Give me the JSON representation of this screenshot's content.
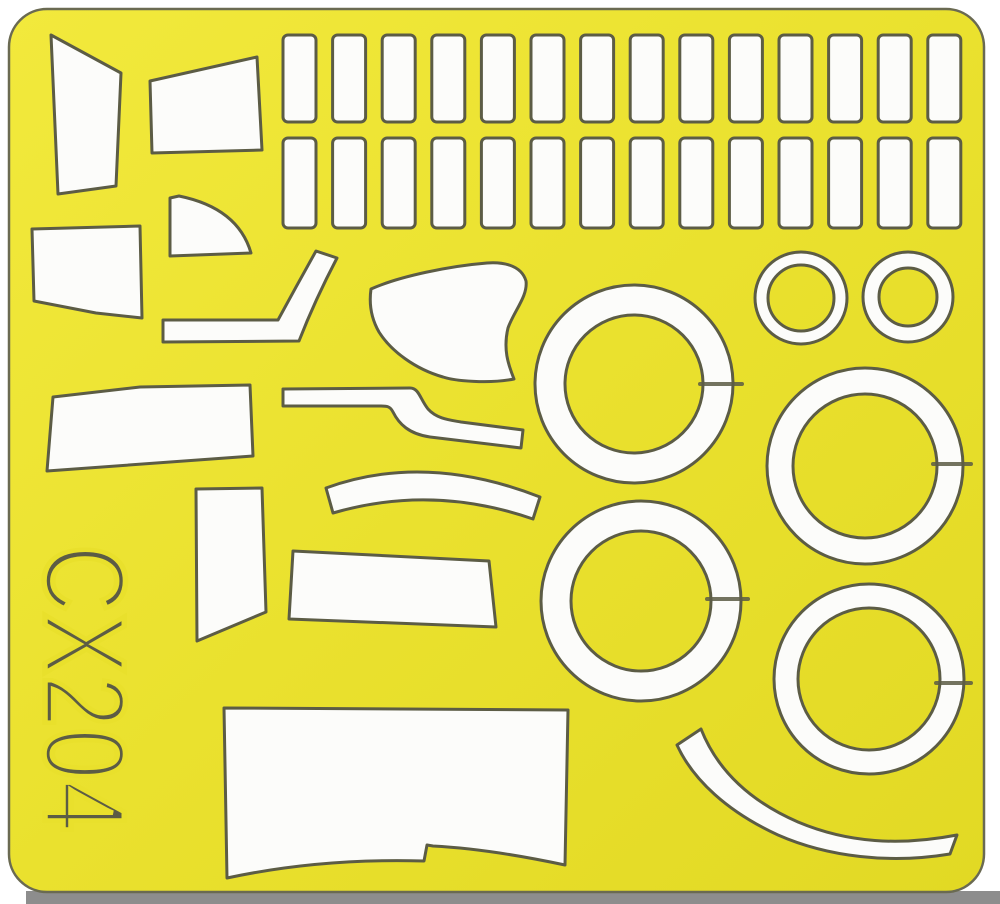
{
  "sheet": {
    "code": "CX204",
    "material_color": "#e9e02c",
    "material_light": "#f2e93c",
    "material_dark": "#e2d924",
    "outline_color": "#5c5c45",
    "mask_fill": "#fcfcfa",
    "shadow_color": "#8d8d8d",
    "background_color": "#ffffff"
  },
  "die_cut": {
    "rect_grid": {
      "columns": 14,
      "x_start": 283,
      "pitch": 49.6,
      "width": 33,
      "corner_radius": 5,
      "rows": [
        {
          "y": 35,
          "height": 87
        },
        {
          "y": 138,
          "height": 90
        }
      ]
    },
    "small_rings": [
      {
        "cx": 801,
        "cy": 298,
        "r_outer": 46,
        "r_inner": 33
      },
      {
        "cx": 908,
        "cy": 297,
        "r_outer": 45,
        "r_inner": 29
      }
    ],
    "wheel_rings": [
      {
        "cx": 634,
        "cy": 384,
        "r_outer": 99,
        "r_inner": 69,
        "slit_y": 384,
        "slit_x1": 700,
        "slit_x2": 742
      },
      {
        "cx": 865,
        "cy": 466,
        "r_outer": 98,
        "r_inner": 72,
        "slit_y": 464,
        "slit_x1": 933,
        "slit_x2": 971
      },
      {
        "cx": 641,
        "cy": 601,
        "r_outer": 100,
        "r_inner": 70,
        "slit_y": 599,
        "slit_x1": 707,
        "slit_x2": 748
      },
      {
        "cx": 869,
        "cy": 679,
        "r_outer": 95,
        "r_inner": 71,
        "slit_y": 683,
        "slit_x1": 936,
        "slit_x2": 971
      }
    ],
    "freeform_mask_count": 13,
    "total_rectangle_count": 28
  }
}
